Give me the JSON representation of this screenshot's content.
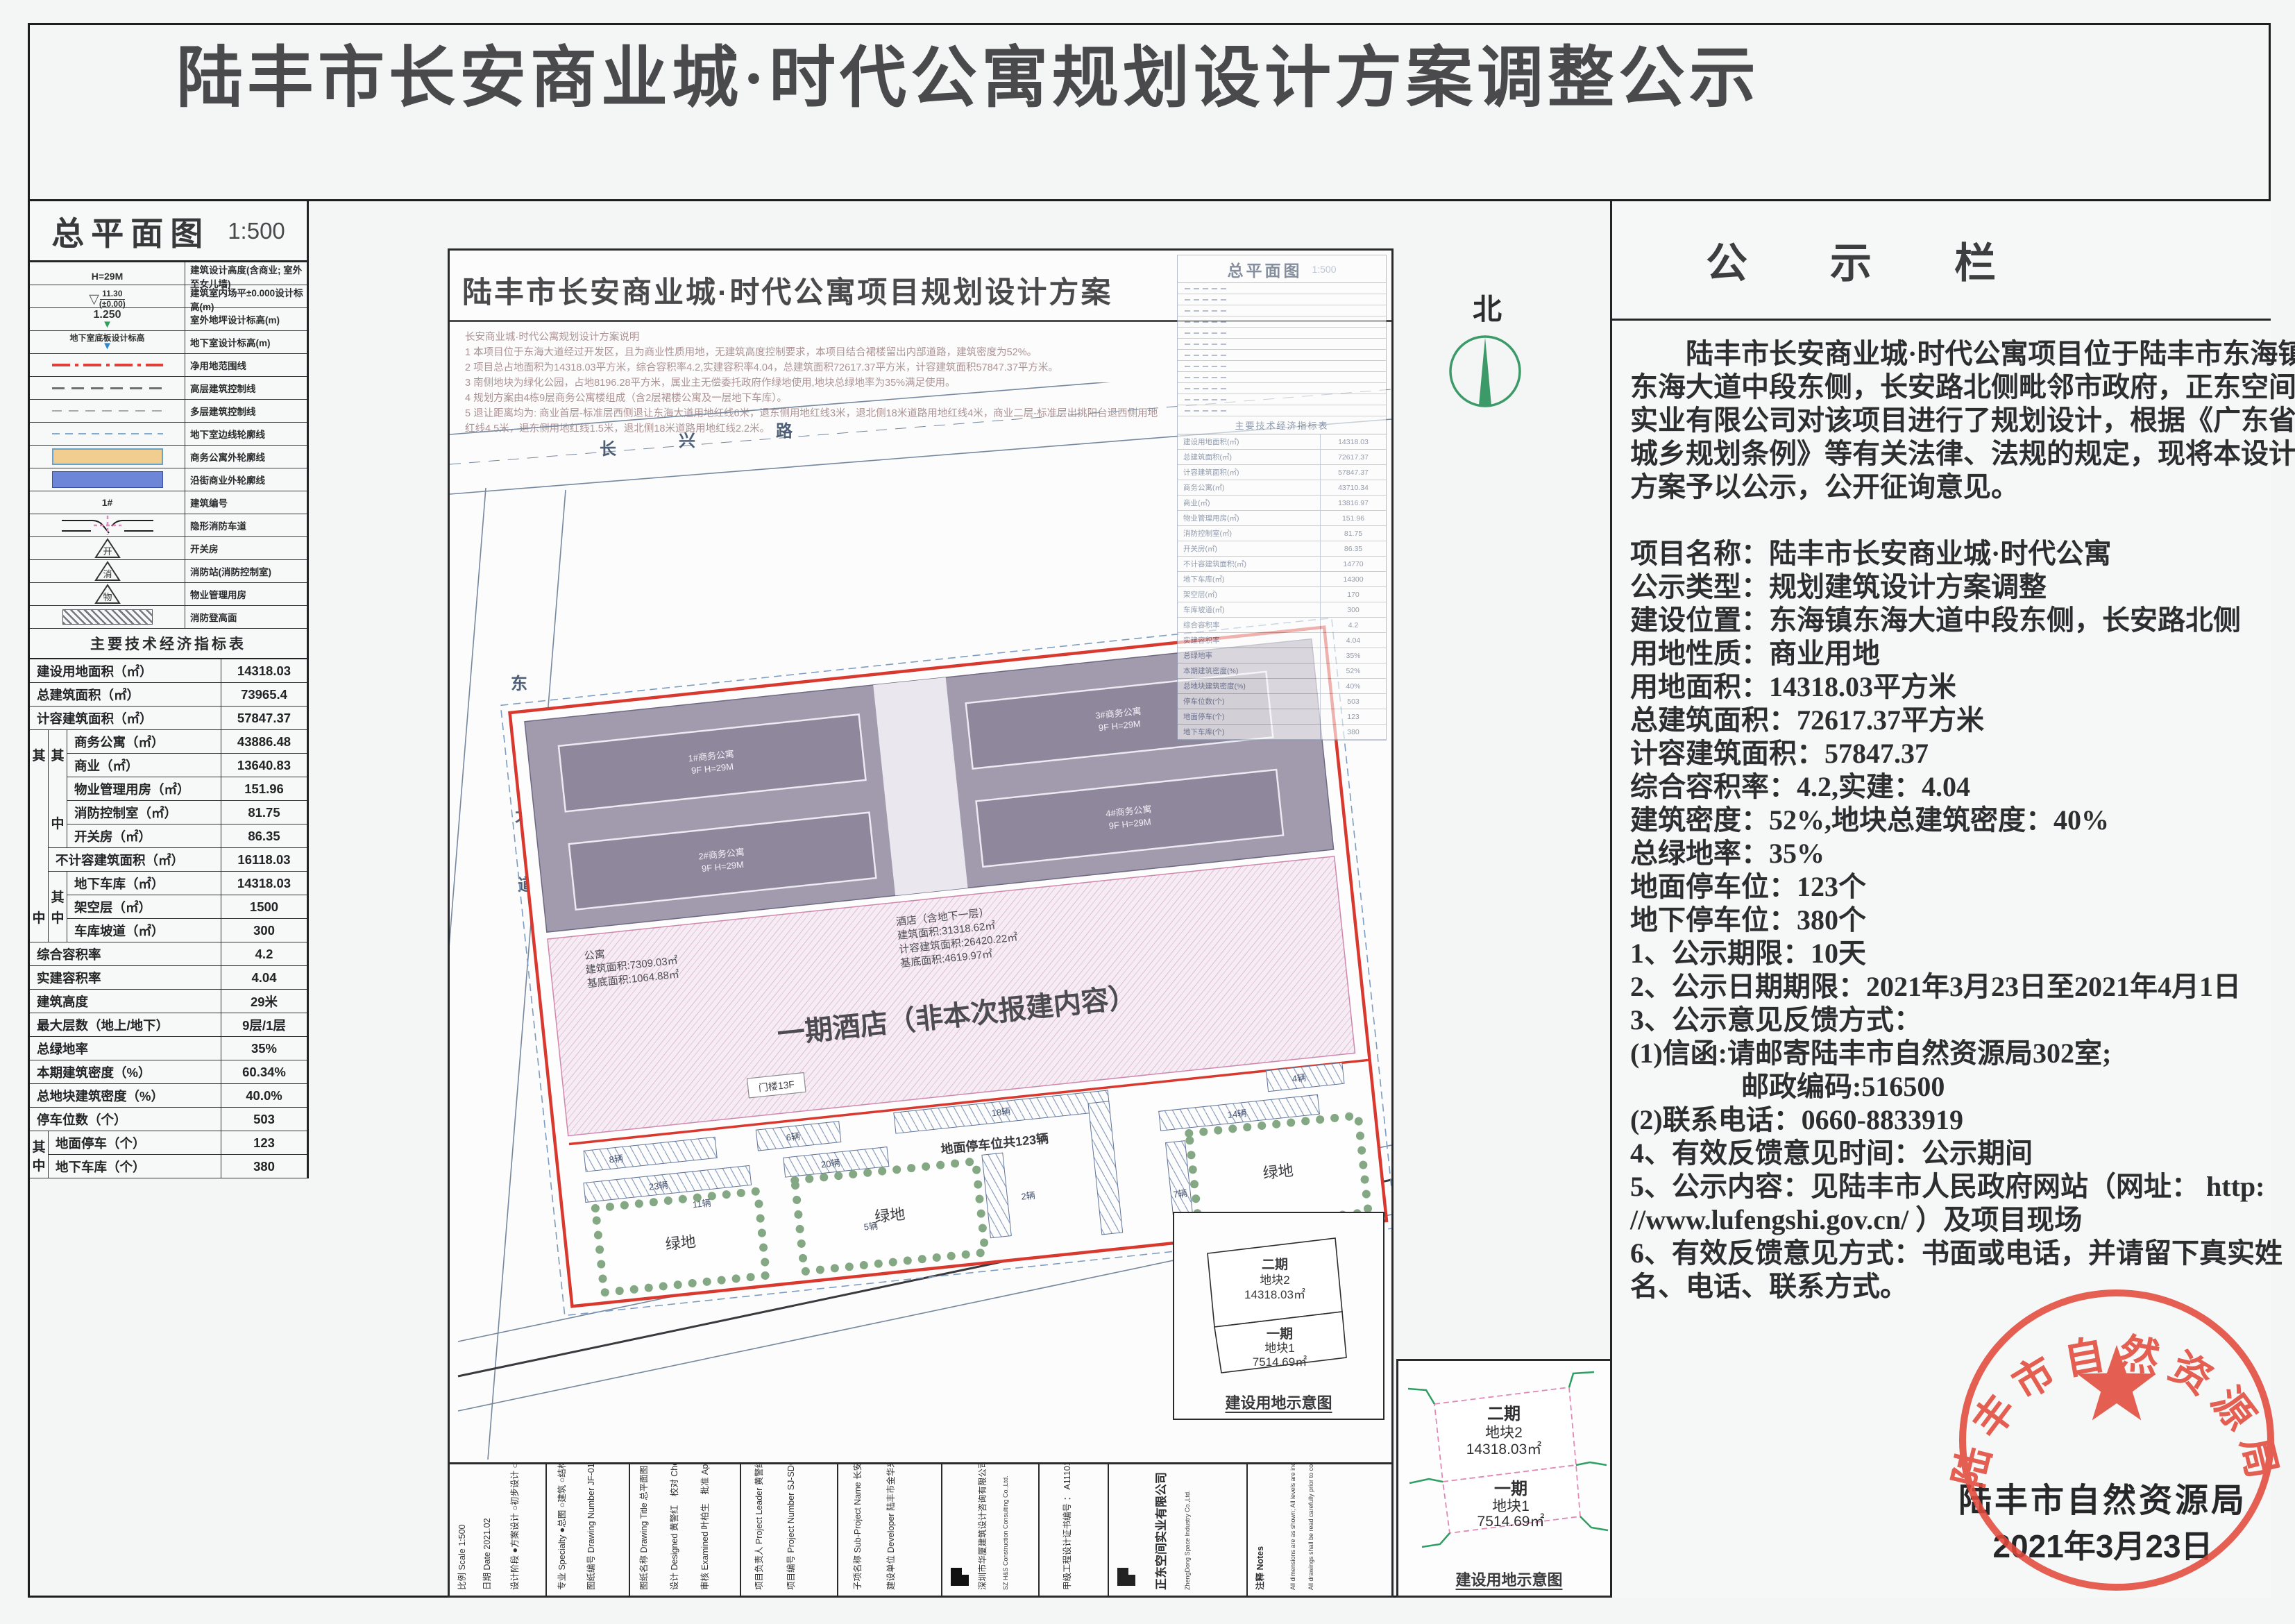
{
  "page_title": "陆丰市长安商业城·时代公寓规划设计方案调整公示",
  "left_panel": {
    "title": "总平面图",
    "scale": "1:500",
    "group_top": "其",
    "group_bottom": "中",
    "legend": [
      {
        "sym": "H=29M",
        "label": "建筑设计高度(含商业; 室外至女儿墙)"
      },
      {
        "sym_top": "11.30",
        "sym_bottom": "(±0.00)",
        "label": "建筑室内场平±0.000设计标高(m)"
      },
      {
        "sym": "1.250",
        "label": "室外地坪设计标高(m)"
      },
      {
        "sym": "地下室底板设计标高",
        "label": "地下室设计标高(m)"
      },
      {
        "label": "净用地范围线"
      },
      {
        "label": "高层建筑控制线"
      },
      {
        "label": "多层建筑控制线"
      },
      {
        "label": "地下室边线轮廓线"
      },
      {
        "label": "商务公寓外轮廓线"
      },
      {
        "label": "沿街商业外轮廓线"
      },
      {
        "sym": "1#",
        "label": "建筑编号"
      },
      {
        "label": "隐形消防车道"
      },
      {
        "sym": "开",
        "label": "开关房"
      },
      {
        "sym": "消",
        "label": "消防站(消防控制室)"
      },
      {
        "sym": "物",
        "label": "物业管理用房"
      },
      {
        "label": "消防登高面"
      }
    ],
    "indicators_title": "主要技术经济指标表",
    "ind": [
      {
        "label": "建设用地面积（㎡）",
        "value": "14318.03"
      },
      {
        "label": "总建筑面积（㎡）",
        "value": "73965.4"
      },
      {
        "label": "计容建筑面积（㎡）",
        "value": "57847.37"
      },
      {
        "label": "商务公寓（㎡）",
        "value": "43886.48"
      },
      {
        "label": "商业（㎡）",
        "value": "13640.83"
      },
      {
        "label": "物业管理用房（㎡）",
        "value": "151.96"
      },
      {
        "label": "消防控制室（㎡）",
        "value": "81.75"
      },
      {
        "label": "开关房（㎡）",
        "value": "86.35"
      },
      {
        "label": "不计容建筑面积（㎡）",
        "value": "16118.03"
      },
      {
        "label": "地下车库（㎡）",
        "value": "14318.03"
      },
      {
        "label": "架空层（㎡）",
        "value": "1500"
      },
      {
        "label": "车库坡道（㎡）",
        "value": "300"
      },
      {
        "label": "综合容积率",
        "value": "4.2"
      },
      {
        "label": "实建容积率",
        "value": "4.04"
      },
      {
        "label": "建筑高度",
        "value": "29米"
      },
      {
        "label": "最大层数（地上/地下）",
        "value": "9层/1层"
      },
      {
        "label": "总绿地率",
        "value": "35%"
      },
      {
        "label": "本期建筑密度（%）",
        "value": "60.34%"
      },
      {
        "label": "总地块建筑密度（%）",
        "value": "40.0%"
      },
      {
        "label": "停车位数（个）",
        "value": "503"
      },
      {
        "label": "地面停车（个）",
        "value": "123"
      },
      {
        "label": "地下车库（个）",
        "value": "380"
      }
    ]
  },
  "sheet": {
    "title": "陆丰市长安商业城·时代公寓项目规划设计方案",
    "notes": [
      "长安商业城·时代公寓规划设计方案说明",
      "1 本项目位于东海大道经过开发区，且为商业性质用地，无建筑高度控制要求，本项目结合裙楼留出内部道路，建筑密度为52%。",
      "2 项目总占地面积为14318.03平方米，综合容积率4.2,实建容积率4.04，总建筑面积72617.37平方米，计容建筑面积57847.37平方米。",
      "3 南侧地块为绿化公园，占地8196.28平方米，属业主无偿委托政府作绿地使用,地块总绿地率为35%满足使用。",
      "4 规划方案由4栋9层商务公寓楼组成（含2层裙楼公寓及一层地下车库）。",
      "5 退让距离均为: 商业首层-标准层西侧退让东海大道用地红线6米，退东侧用地红线3米，退北侧18米道路用地红线4米，商业二层-标准层出挑阳台退西侧用地红线4.5米，退东侧用地红线1.5米，退北侧18米道路用地红线2.2米。"
    ],
    "plan": {
      "hotel_zone_label": "一期酒店（非本次报建内容）",
      "hotel_info": [
        "酒店（含地下一层）",
        "建筑面积:31318.62㎡",
        "计容建筑面积:26420.22㎡",
        "基底面积:4619.97㎡"
      ],
      "apt_info": [
        "公寓",
        "建筑面积:7309.03㎡",
        "基底面积:1064.88㎡"
      ],
      "gate": "门楼13F",
      "parking_total": "地面停车位共123辆",
      "green": "绿地",
      "slabs": [
        "1#商务公寓",
        "2#商务公寓",
        "3#商务公寓",
        "4#商务公寓"
      ],
      "slab_sub": "9F H=29M",
      "roads": {
        "n1": "长",
        "n2": "兴",
        "n3": "路",
        "w1": "东",
        "w2": "海",
        "w3": "大",
        "w4": "道",
        "s1": "长",
        "s2": "安",
        "s3": "路",
        "gov": "市政府"
      },
      "counts": [
        "8辆",
        "6辆",
        "18辆",
        "4辆",
        "23辆",
        "20辆",
        "14辆",
        "5辆",
        "2辆",
        "7辆",
        "11辆"
      ]
    },
    "mini_table": {
      "title": "总平面图",
      "scale": "1:500",
      "header": "主要技术经济指标表",
      "rows": [
        {
          "l": "建设用地面积(㎡)",
          "v": "14318.03"
        },
        {
          "l": "总建筑面积(㎡)",
          "v": "72617.37"
        },
        {
          "l": "计容建筑面积(㎡)",
          "v": "57847.37"
        },
        {
          "l": "商务公寓(㎡)",
          "v": "43710.34"
        },
        {
          "l": "商业(㎡)",
          "v": "13816.97"
        },
        {
          "l": "物业管理用房(㎡)",
          "v": "151.96"
        },
        {
          "l": "消防控制室(㎡)",
          "v": "81.75"
        },
        {
          "l": "开关房(㎡)",
          "v": "86.35"
        },
        {
          "l": "不计容建筑面积(㎡)",
          "v": "14770"
        },
        {
          "l": "地下车库(㎡)",
          "v": "14300"
        },
        {
          "l": "架空层(㎡)",
          "v": "170"
        },
        {
          "l": "车库坡道(㎡)",
          "v": "300"
        },
        {
          "l": "综合容积率",
          "v": "4.2"
        },
        {
          "l": "实建容积率",
          "v": "4.04"
        },
        {
          "l": "总绿地率",
          "v": "35%"
        },
        {
          "l": "本期建筑密度(%)",
          "v": "52%"
        },
        {
          "l": "总地块建筑密度(%)",
          "v": "40%"
        },
        {
          "l": "停车位数(个)",
          "v": "503"
        },
        {
          "l": "地面停车(个)",
          "v": "123"
        },
        {
          "l": "地下车库(个)",
          "v": "380"
        }
      ]
    },
    "titleblock": {
      "c1a": "比例 Scale  1:500",
      "c1b": "日期 Date  2021.02",
      "c1c": "设计阶段  ●方案设计 ○初步设计 ○施工图设计",
      "c2a": "专业 Specialty  ●总图 ○建筑 ○结构 ○给排水 ○电气",
      "c2b": "图纸编号 Drawing Number  JF-01",
      "c3a": "图纸名称 Drawing Title  总平面图",
      "c3b": "设计 Designed 黄警红　校对 Checked 罗琼",
      "c3c": "审核 Examined 叶柏生　批准 Approved 黄警红",
      "c4a": "项目负责人 Project Leader  黄警红",
      "c4b": "项目编号 Project Number  SJ-SDGY-2020",
      "c5a": "子项名称 Sub-Project Name  长安商业城·时代公寓",
      "c5b": "建设单位 Developer  陆丰市金华来花园酒店有限公司",
      "c6a": "深圳市华厦建筑设计咨询有限公司",
      "c6b": "SZ H&S Construction Consulting Co.,Ltd.",
      "c7": "甲级工程设计证书编号 ： A111010311",
      "c8a": "正东空间实业有限公司",
      "c8b": "ZhengDong Space Industry Co.,Ltd.",
      "c9a": "注释 Notes",
      "c9b": "All dimensions are as shown; All levels are indicated in meter, and the other dimensions are in millimeter unless noted otherwise;",
      "c9c": "All drawings shall be read carefully prior to construction; Any change to the design shall be agreed in writing by design engineer prior to construction."
    }
  },
  "parcel_inset": {
    "phase2": "二期",
    "parcel2": "地块2",
    "area2": "14318.03㎡",
    "phase1": "一期",
    "parcel1": "地块1",
    "area1": "7514.69㎡",
    "caption": "建设用地示意图"
  },
  "north_label": "北",
  "notice": {
    "header": "公 示 栏",
    "lines": [
      "　　陆丰市长安商业城·时代公寓项目位于陆丰市东海镇",
      "东海大道中段东侧，长安路北侧毗邻市政府，正东空间",
      "实业有限公司对该项目进行了规划设计，根据《广东省",
      "城乡规划条例》等有关法律、法规的规定，现将本设计",
      "方案予以公示，公开征询意见。",
      "",
      "项目名称：陆丰市长安商业城·时代公寓",
      "公示类型：规划建筑设计方案调整",
      "建设位置：东海镇东海大道中段东侧，长安路北侧",
      "用地性质：商业用地",
      "用地面积：14318.03平方米",
      "总建筑面积：72617.37平方米",
      "计容建筑面积：57847.37",
      "综合容积率：4.2,实建：4.04",
      "建筑密度：52%,地块总建筑密度：40%",
      "总绿地率：35%",
      "地面停车位：123个",
      "地下停车位：380个",
      "1、公示期限：10天",
      "2、公示日期期限：2021年3月23日至2021年4月1日",
      "3、公示意见反馈方式：",
      "(1)信函:请邮寄陆丰市自然资源局302室;",
      "　　　　邮政编码:516500",
      "(2)联系电话：0660-8833919",
      "4、有效反馈意见时间：公示期间",
      "5、公示内容：见陆丰市人民政府网站（网址： http:",
      "//www.lufengshi.gov.cn/ ）及项目现场",
      "6、有效反馈意见方式：书面或电话，并请留下真实姓",
      "名、电话、联系方式。"
    ]
  },
  "seal": {
    "ring_text": "陆丰市自然资源局",
    "agency": "陆丰市自然资源局",
    "date": "2021年3月23日"
  }
}
